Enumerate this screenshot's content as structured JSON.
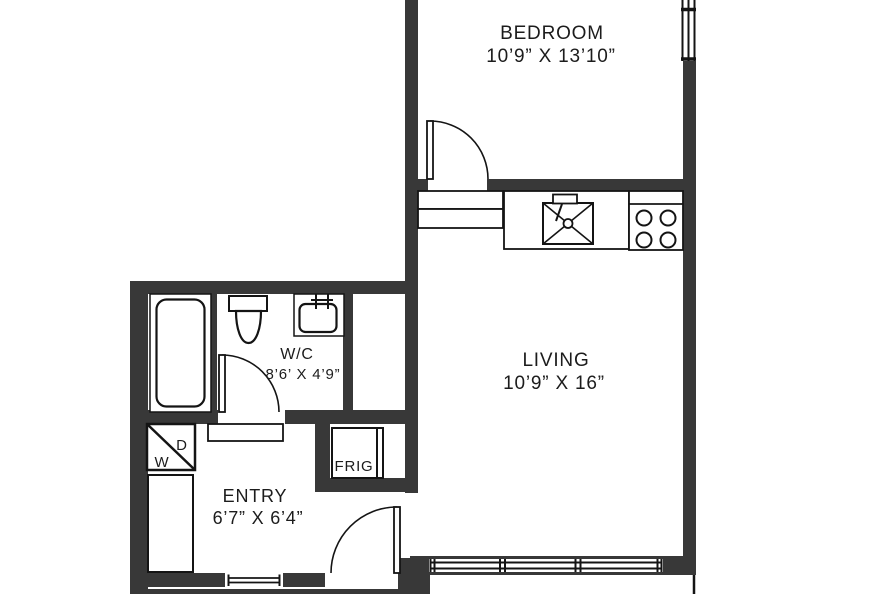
{
  "colors": {
    "wall": "#383838",
    "line": "#141414",
    "text": "#1c1c1c",
    "bg": "#ffffff"
  },
  "rooms": {
    "bedroom": {
      "name": "BEDROOM",
      "dimensions": "10’9” X 13’10”"
    },
    "living": {
      "name": "LIVING",
      "dimensions": "10’9” X 16”"
    },
    "wc": {
      "name": "W/C",
      "dimensions": "8’6’ X 4’9”"
    },
    "entry": {
      "name": "ENTRY",
      "dimensions": "6’7” X 6’4”"
    }
  },
  "appliances": {
    "fridge_label": "FRIG",
    "dryer_label": "D",
    "washer_label": "W"
  }
}
